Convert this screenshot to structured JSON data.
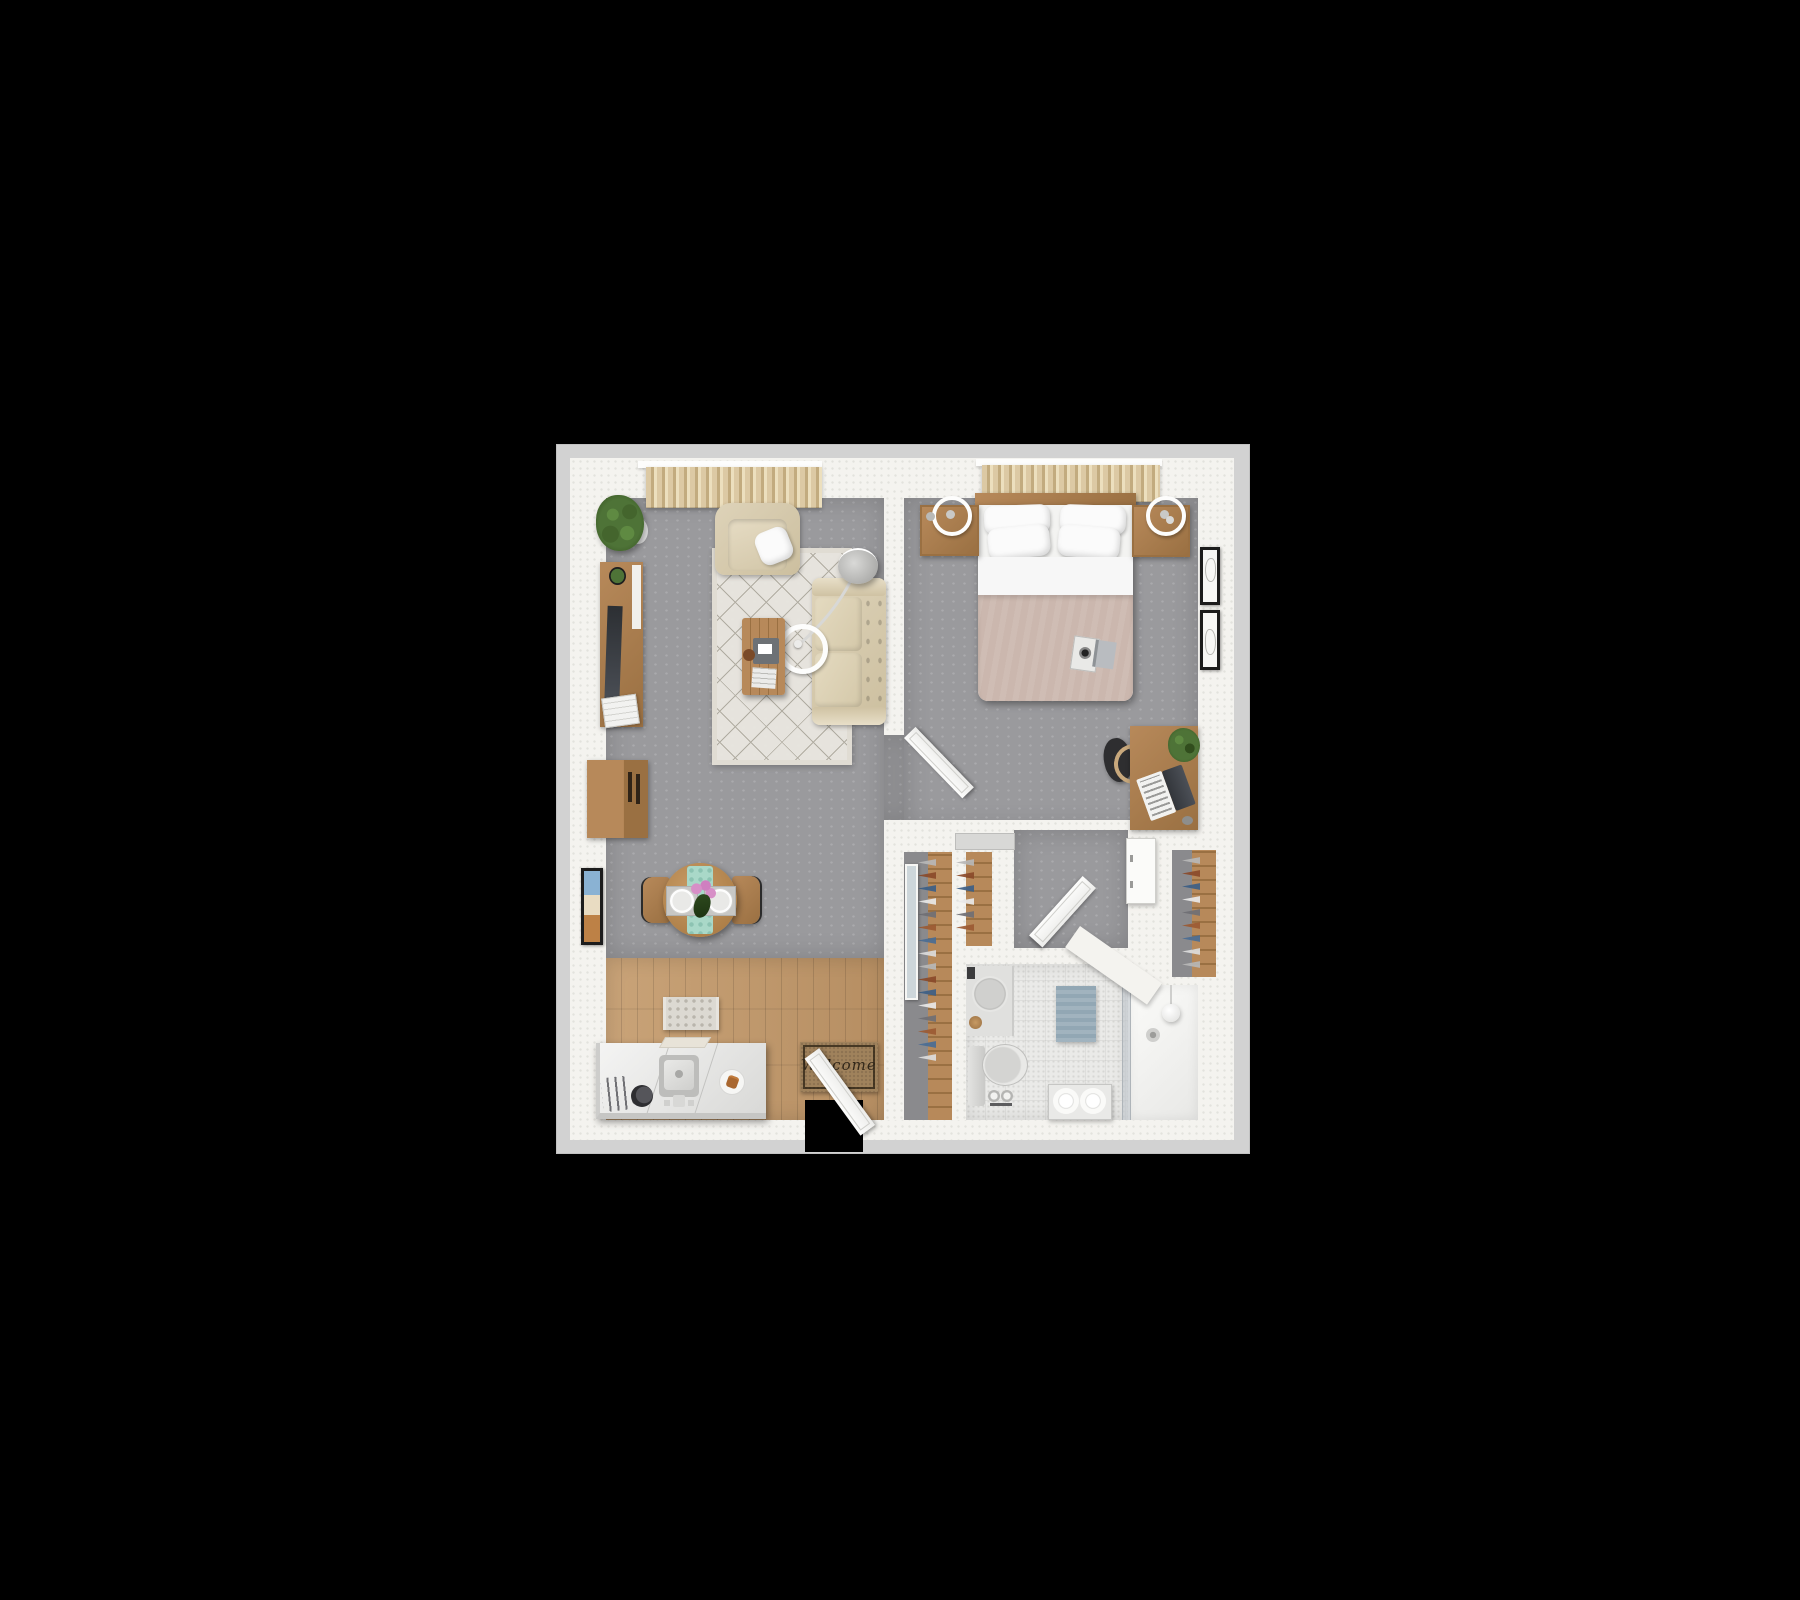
{
  "scene": {
    "kind": "3d-floor-plan-top-view",
    "description": "One-bedroom apartment 3D floor plan rendered top-down on a black background",
    "background": "#000000"
  },
  "texts": {
    "welcome_mat": "Welcome"
  },
  "colors": {
    "plate": "#d2d2d2",
    "wall": "#f4f3ef",
    "floor-gray": "#9a9a9d",
    "wood-floor": "#c9a378",
    "wood-furniture": "#b7895a",
    "rug": "#eae7e0",
    "sofa-beige": "#ded3b9",
    "curtain": "#dcc9a4",
    "blanket-mauve": "#cbb7ae",
    "tile": "#eaeae8",
    "bath-mat-blue": "#92a7b4",
    "runner-teal": "#a9d8c8",
    "accent-plant": "#4e7337"
  },
  "closets": {
    "clothes_colors": [
      "#b7b7b7",
      "#8a4a2a",
      "#3c5e86",
      "#e8e8e8",
      "#6f6f74",
      "#9b5a33",
      "#4a6d94",
      "#dcdcdc"
    ]
  },
  "rooms": [
    {
      "name": "living-room",
      "floor": "gray-carpet"
    },
    {
      "name": "dining-area",
      "floor": "gray-carpet"
    },
    {
      "name": "kitchen-entry",
      "floor": "wood-plank"
    },
    {
      "name": "bedroom",
      "floor": "gray-carpet"
    },
    {
      "name": "closet-hall",
      "floor": "gray-carpet"
    },
    {
      "name": "bathroom",
      "floor": "tile"
    },
    {
      "name": "shower",
      "floor": "white"
    }
  ],
  "furniture": {
    "living_room": [
      "window-curtains",
      "potted-plant",
      "tv-console",
      "tv",
      "printer",
      "armchair",
      "throw-pillow",
      "area-rug",
      "sofa",
      "arc-floor-lamp",
      "ring-lamp-base",
      "coffee-table",
      "bookcase",
      "wall-art",
      "dining-table",
      "table-runner",
      "place-settings",
      "dining-chairs",
      "flowers"
    ],
    "kitchen_entry": [
      "kitchen-island",
      "sink",
      "toaster",
      "coffee-grinder",
      "plate-with-croissant",
      "cutting-board",
      "small-rug",
      "welcome-mat",
      "entry-door"
    ],
    "bedroom": [
      "window-curtains",
      "headboard-shelf",
      "double-bed",
      "pillows",
      "blanket",
      "camera",
      "book",
      "nightstand-left",
      "nightstand-right",
      "wall-sconce-left",
      "wall-sconce-right",
      "desk",
      "laptop",
      "desk-plant",
      "desk-chair",
      "mouse",
      "wall-art-frames",
      "bedroom-door"
    ],
    "closet_hall": [
      "wardrobe-left",
      "wardrobe-middle",
      "standing-mirror",
      "wall-cabinet",
      "wardrobe-right-niche",
      "bathroom-door"
    ],
    "bathroom": [
      "vanity-sink",
      "toilet",
      "toilet-paper-stand",
      "bath-mat",
      "towel-bench",
      "glass-shower-screen",
      "shower-drain",
      "pendant-light"
    ]
  }
}
